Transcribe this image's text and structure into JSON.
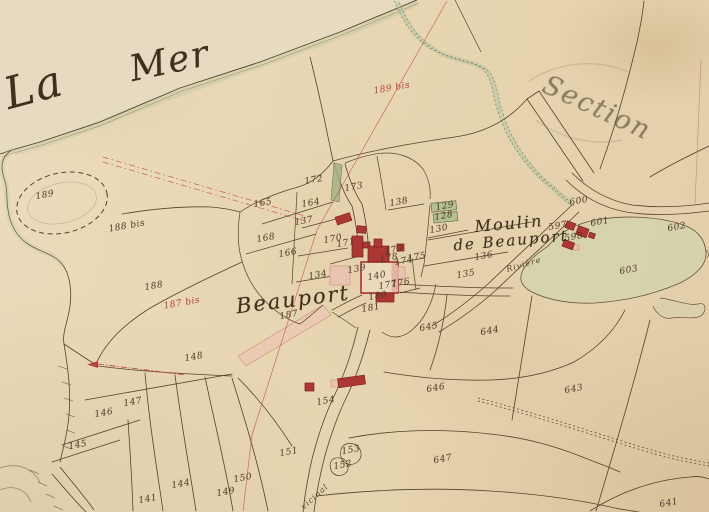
{
  "map": {
    "palette": {
      "paper": "#e8d6b2",
      "sea": "#e6dbc1",
      "ink": "#54422c",
      "red_ink": "#b5413c",
      "building_red": "#ad3733",
      "building_pink": "#e9c3b0",
      "garden_green": "#a9b989",
      "water_green": "#c9d5ae",
      "pencil": "#7d7260"
    },
    "place_labels": [
      {
        "text": "La",
        "x": 34,
        "y": 88,
        "rot": -15,
        "size": 44
      },
      {
        "text": "Mer",
        "x": 170,
        "y": 62,
        "rot": -12,
        "size": 36
      },
      {
        "text": "Beauport",
        "x": 293,
        "y": 300,
        "rot": -7,
        "size": 21
      },
      {
        "text": "Moulin",
        "x": 509,
        "y": 224,
        "rot": -5,
        "size": 16
      },
      {
        "text": "de Beauport",
        "x": 511,
        "y": 241,
        "rot": -5,
        "size": 15
      },
      {
        "text": "Section",
        "x": 597,
        "y": 108,
        "rot": 25,
        "size": 27,
        "color": "rgba(125,112,90,0.35)"
      }
    ],
    "road_labels": [
      {
        "text": "Rivière",
        "x": 524,
        "y": 265,
        "rot": -16
      },
      {
        "text": "vicinal",
        "x": 315,
        "y": 497,
        "rot": -42
      }
    ],
    "parcel_numbers": [
      {
        "text": "189",
        "x": 45,
        "y": 196
      },
      {
        "text": "188 bis",
        "x": 127,
        "y": 227
      },
      {
        "text": "188",
        "x": 154,
        "y": 287
      },
      {
        "text": "187 bis",
        "x": 182,
        "y": 304,
        "red": true
      },
      {
        "text": "187",
        "x": 289,
        "y": 316
      },
      {
        "text": "165",
        "x": 263,
        "y": 204
      },
      {
        "text": "164",
        "x": 311,
        "y": 204
      },
      {
        "text": "168",
        "x": 266,
        "y": 239
      },
      {
        "text": "166",
        "x": 288,
        "y": 254
      },
      {
        "text": "189 bis",
        "x": 392,
        "y": 89,
        "red": true
      },
      {
        "text": "172",
        "x": 314,
        "y": 181
      },
      {
        "text": "173",
        "x": 354,
        "y": 188
      },
      {
        "text": "138",
        "x": 399,
        "y": 203
      },
      {
        "text": "137",
        "x": 304,
        "y": 222
      },
      {
        "text": "134",
        "x": 318,
        "y": 276
      },
      {
        "text": "170",
        "x": 333,
        "y": 240
      },
      {
        "text": "171",
        "x": 346,
        "y": 244
      },
      {
        "text": "139",
        "x": 357,
        "y": 270
      },
      {
        "text": "140",
        "x": 377,
        "y": 277
      },
      {
        "text": "179",
        "x": 394,
        "y": 251
      },
      {
        "text": "178",
        "x": 389,
        "y": 259
      },
      {
        "text": "174",
        "x": 404,
        "y": 262
      },
      {
        "text": "175",
        "x": 417,
        "y": 258
      },
      {
        "text": "176",
        "x": 401,
        "y": 284
      },
      {
        "text": "177",
        "x": 388,
        "y": 286
      },
      {
        "text": "180",
        "x": 378,
        "y": 297
      },
      {
        "text": "181",
        "x": 371,
        "y": 309
      },
      {
        "text": "129",
        "x": 445,
        "y": 207
      },
      {
        "text": "128",
        "x": 444,
        "y": 217
      },
      {
        "text": "130",
        "x": 439,
        "y": 230
      },
      {
        "text": "136",
        "x": 484,
        "y": 257
      },
      {
        "text": "135",
        "x": 466,
        "y": 275
      },
      {
        "text": "148",
        "x": 194,
        "y": 358
      },
      {
        "text": "147",
        "x": 133,
        "y": 403
      },
      {
        "text": "146",
        "x": 104,
        "y": 414
      },
      {
        "text": "145",
        "x": 78,
        "y": 446
      },
      {
        "text": "144",
        "x": 181,
        "y": 485
      },
      {
        "text": "141",
        "x": 148,
        "y": 500
      },
      {
        "text": "149",
        "x": 226,
        "y": 493
      },
      {
        "text": "150",
        "x": 243,
        "y": 479
      },
      {
        "text": "151",
        "x": 289,
        "y": 453
      },
      {
        "text": "153",
        "x": 351,
        "y": 451
      },
      {
        "text": "152",
        "x": 343,
        "y": 466
      },
      {
        "text": "154",
        "x": 326,
        "y": 402
      },
      {
        "text": "645",
        "x": 429,
        "y": 328
      },
      {
        "text": "644",
        "x": 490,
        "y": 332
      },
      {
        "text": "646",
        "x": 436,
        "y": 389
      },
      {
        "text": "647",
        "x": 443,
        "y": 460
      },
      {
        "text": "643",
        "x": 574,
        "y": 390
      },
      {
        "text": "641",
        "x": 669,
        "y": 504
      },
      {
        "text": "597",
        "x": 558,
        "y": 227
      },
      {
        "text": "598",
        "x": 574,
        "y": 238
      },
      {
        "text": "600",
        "x": 579,
        "y": 202
      },
      {
        "text": "601",
        "x": 600,
        "y": 223
      },
      {
        "text": "602",
        "x": 677,
        "y": 228
      },
      {
        "text": "603",
        "x": 629,
        "y": 271
      }
    ]
  }
}
